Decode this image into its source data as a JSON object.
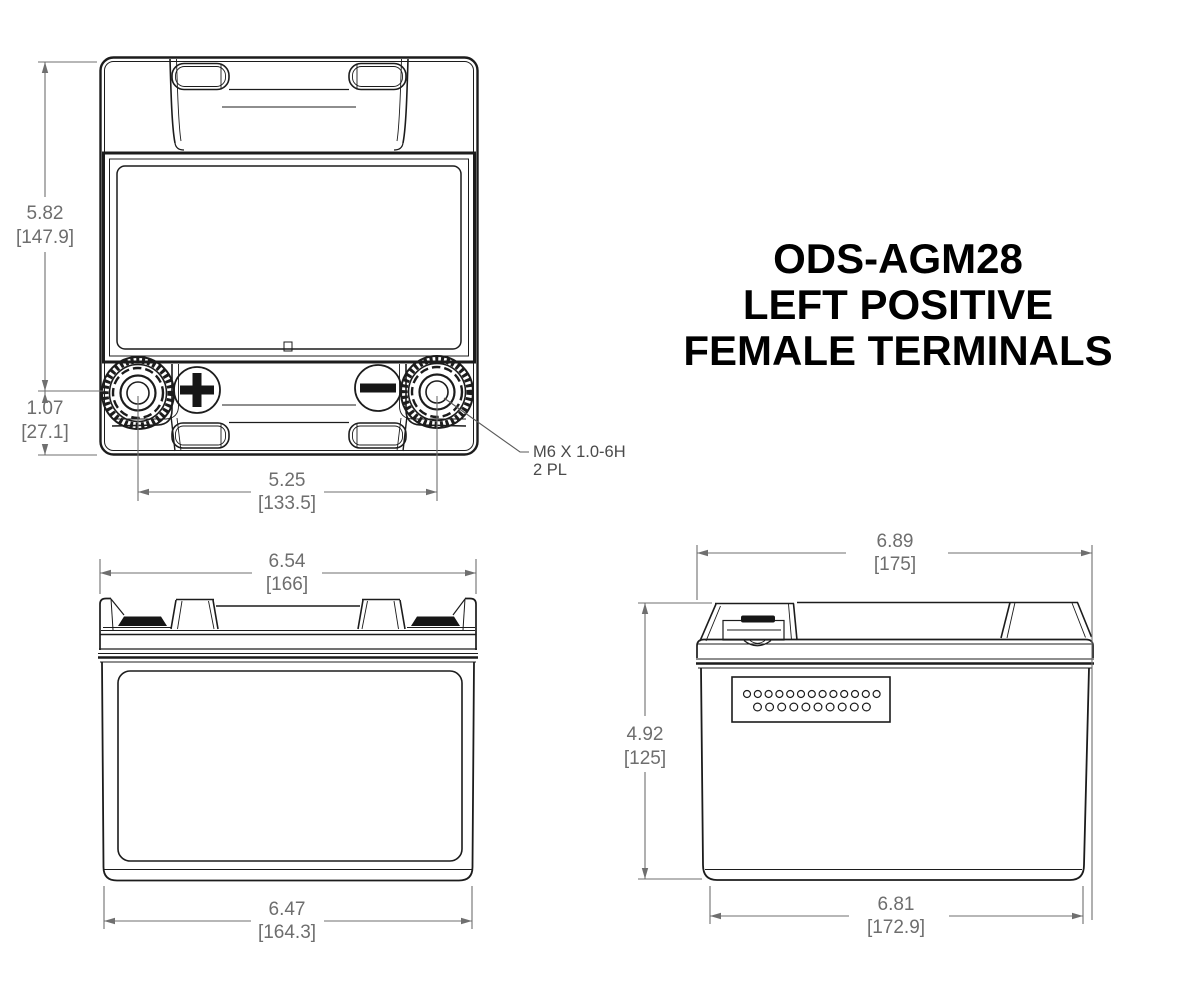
{
  "title_block": {
    "lines": [
      "ODS-AGM28",
      "LEFT POSITIVE",
      "FEMALE TERMINALS"
    ]
  },
  "colors": {
    "drawing_line": "#1c1c1c",
    "dimension": "#6e6e6e",
    "terminal_fill": "#161616",
    "background": "#ffffff"
  },
  "views": {
    "top": {
      "dims": {
        "body_height": {
          "inches": "5.82",
          "millimeters": "[147.9]"
        },
        "terminal_row_height": {
          "inches": "1.07",
          "millimeters": "[27.1]"
        },
        "terminal_spacing": {
          "inches": "5.25",
          "millimeters": "[133.5]"
        }
      },
      "terminal_callout": {
        "line1": "M6 X 1.0-6H",
        "line2": "2 PL"
      },
      "polarity": {
        "positive_symbol": "+",
        "negative_symbol": "−"
      }
    },
    "front": {
      "dims": {
        "overall_width": {
          "inches": "6.54",
          "millimeters": "[166]"
        },
        "base_width": {
          "inches": "6.47",
          "millimeters": "[164.3]"
        }
      }
    },
    "side": {
      "dims": {
        "overall_depth": {
          "inches": "6.89",
          "millimeters": "[175]"
        },
        "overall_height": {
          "inches": "4.92",
          "millimeters": "[125]"
        },
        "base_depth": {
          "inches": "6.81",
          "millimeters": "[172.9]"
        }
      }
    }
  }
}
